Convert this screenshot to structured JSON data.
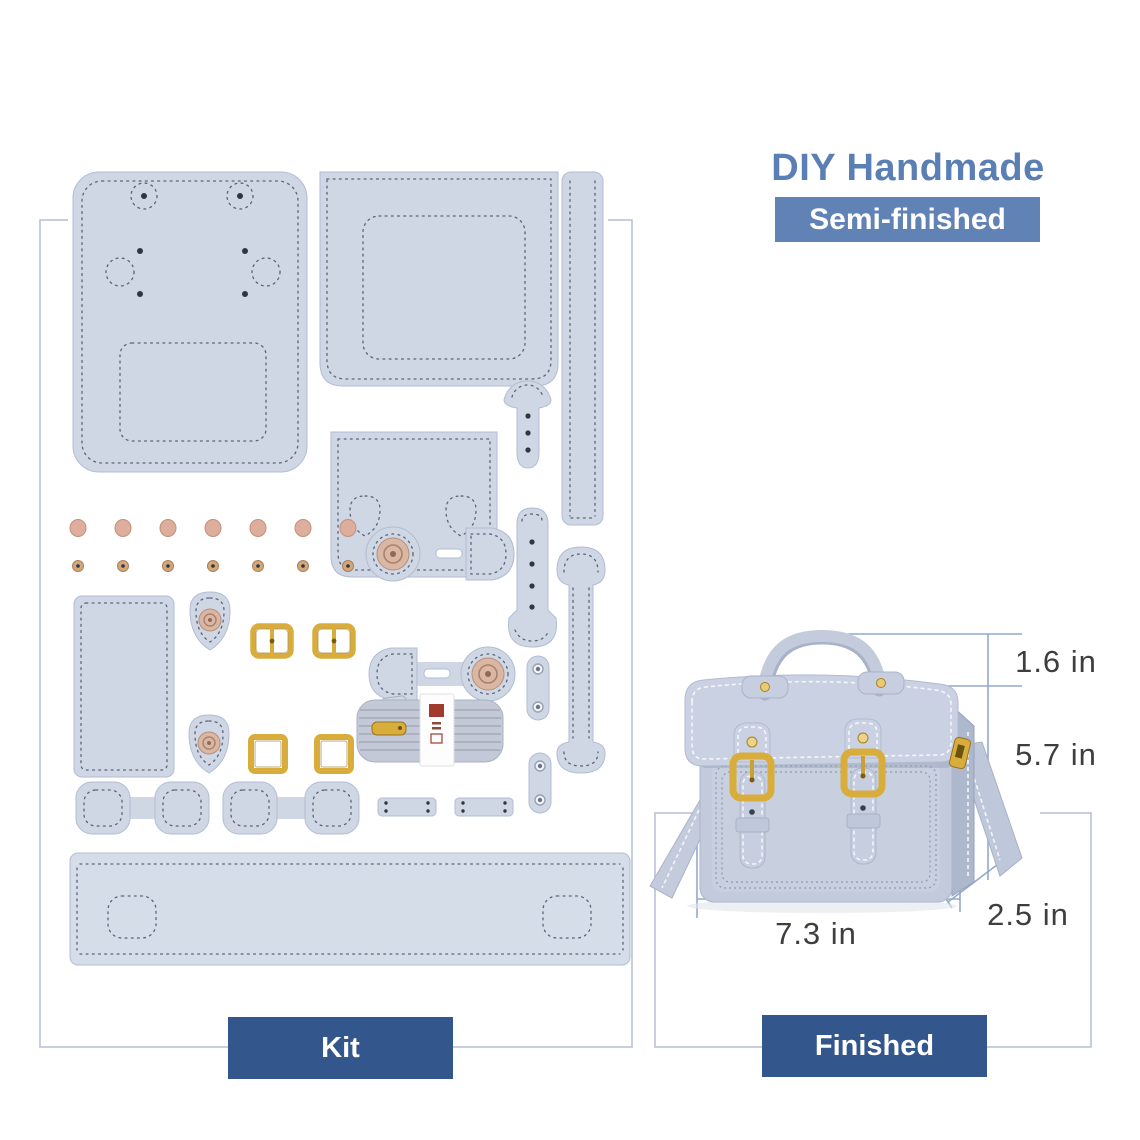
{
  "header": {
    "title": "DIY Handmade",
    "badge": "Semi-finished"
  },
  "kit_section": {
    "label": "Kit"
  },
  "finished_section": {
    "label": "Finished"
  },
  "dimensions": {
    "handle_height": "1.6 in",
    "bag_height": "5.7 in",
    "bag_width": "7.3 in",
    "bag_depth": "2.5 in"
  },
  "colors": {
    "accent_blue": "#5a7fb5",
    "badge_blue": "#6182b4",
    "label_navy": "#33568c",
    "leather": "#cfd7e5",
    "gold_hardware": "#d9ad3c",
    "rivet_pink": "#dcae9b",
    "frame_line": "#b9c3d6",
    "measure_line": "#93a9cc",
    "dimension_text": "#3e3e3e"
  }
}
